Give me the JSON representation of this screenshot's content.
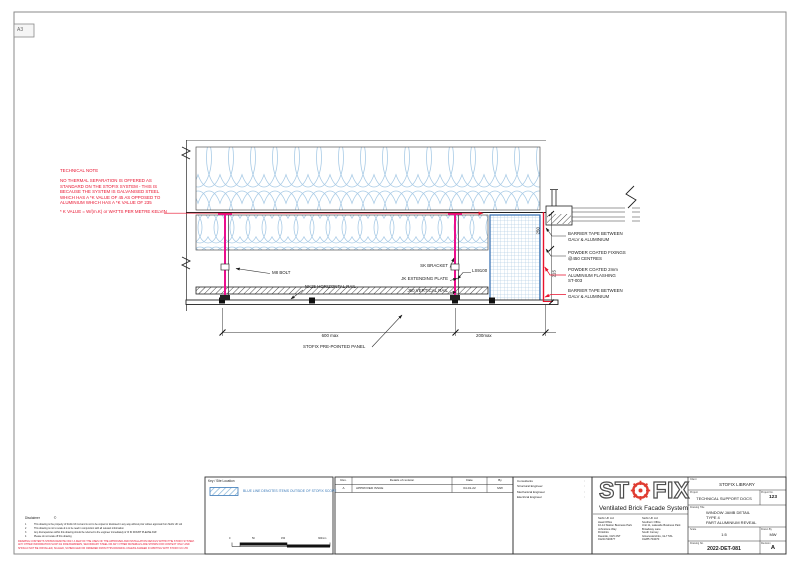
{
  "sheet": {
    "format_label": "A3"
  },
  "technical_note": {
    "title": "TECHNICAL NOTE",
    "lines": [
      "NO THERMAL SEPARATION IS OFFERED AS",
      "STANDARD ON THE STOFIX SYSTEM - THIS IS",
      "BECAUSE THE SYSTEM IS GALVANISED STEEL",
      "WHICH HAS A *K VALUE OF 45 AS OPPOSED TO",
      "ALUMINIUM WHICH HAS A *K VALUE OF 235"
    ],
    "footnote": "* K VALUE = W/(m.K) or WATTS PER METRE KELVIN"
  },
  "callouts": {
    "m8_bolt": "M8 BOLT",
    "nk25_rail": "NK25 HORIZONTAL RAIL",
    "sk_bracket": "SK BRACKET",
    "jk_plate": "JK EXTENDING PLATE",
    "j60_rail": "J60 VERTICAL RAIL",
    "ls9100": "LS9100",
    "barrier_tape_upper": [
      "BARRIER TAPE BETWEEN",
      "GALV & ALUMINIUM"
    ],
    "fixings": [
      "POWDER COATED FIXINGS",
      "@450 CENTRES"
    ],
    "flashing": [
      "POWDER COATED 2mm",
      "ALUMINIUM FLASHING",
      "ST-003"
    ],
    "barrier_tape_lower": [
      "BARRIER TAPE BETWEEN",
      "GALV & ALUMINIUM"
    ],
    "panel": "STOFIX PRE-POINTED PANEL"
  },
  "dimensions": {
    "span_main": "600 max",
    "span_right": "200max",
    "vert_upper": "250",
    "vert_lower": "215"
  },
  "disclaimer": {
    "title": "Disclaimer",
    "copyright": "©",
    "items": [
      {
        "num": "1",
        "text": "This drawing is the property of Stofix UK Ltd and is not to be copied or disclosed in any way without prior written approval from Stofix UK Ltd"
      },
      {
        "num": "2",
        "text": "This drawing is not to scale & is to be read in conjunction with all relevant information"
      },
      {
        "num": "3",
        "text": "Any discrepancies within this drawing should be referred to the engineer immediately & 'IF IN DOUBT PLEASE ASK'"
      },
      {
        "num": "4",
        "text": "Please do not scale off this drawing"
      }
    ],
    "warning": "DRAWING CONTENTS SHOWN DENOTE ONLY A FEW OF THE USES OF THE APPROVED AND INSTALLATION DETAILS WITHIN THE STOFIX SYSTEM. ANY OTHER INFORMATION SUCH AS FIRE BARRIERS, SECONDARY STEEL OR ANY OTHER MATERIALS ARE SHOWN FOR CONTEXT ONLY AND SHOULD NOT BE INSTALLED, SCALED, SCHEDULED OR ORDERED FROM THIS DRAWING UNLESS AGREED IN WRITING WITH STOFIX UK LTD"
  },
  "key_box": {
    "title": "Key / Site Location",
    "legend_text": "BLUE LINE DENOTES ITEMS OUTSIDE OF STOFIX SCOPE",
    "scale_bar_labels": [
      "0",
      "50",
      "150",
      "300mm"
    ]
  },
  "revision_table": {
    "headers": {
      "rev": "Rev.",
      "details": "Details of revision",
      "date": "Date",
      "by": "By"
    },
    "rows": [
      {
        "rev": "A",
        "details": "APPROVED ISSUE",
        "date": "04-01-22",
        "by": "MW"
      }
    ]
  },
  "consultants": {
    "rows": [
      {
        "label": "Consultants",
        "sep": ":"
      },
      {
        "label": "Structural Engineer",
        "sep": ":"
      },
      {
        "label": "Mechanical Engineer",
        "sep": ":"
      },
      {
        "label": "Electrical Engineer",
        "sep": ":"
      }
    ]
  },
  "title_block": {
    "logo": {
      "left": "ST",
      "right": "FIX",
      "tagline": "Ventilated Brick Facade System"
    },
    "address_left": [
      "Stofix UK Ltd",
      "Head Office",
      "10-14 Station Business Park",
      "Johnstone Way",
      "Flintshire",
      "Deeside, CH5 2NT",
      "01244 520677"
    ],
    "address_right": [
      "Stofix UK Ltd",
      "Southern Office",
      "Unit 11, Lakeside Business Park",
      "Broadway Lane",
      "South Cerney",
      "Gloucestershire, GL7 5XL",
      "01285 704070"
    ],
    "fields": {
      "client_label": "Client",
      "client": "STOFIX LIBRARY",
      "project_label": "Project",
      "project": "TECHNICAL SUPPORT DOCS",
      "project_no_label": "Project No.",
      "project_no": "123",
      "drawing_title_label": "Drawing Title",
      "drawing_title_lines": [
        "WINDOW JAMB DETAIL",
        "TYPE 4",
        "PART ALUMINIUM REVEAL"
      ],
      "scale_label": "Scale",
      "scale": "1:5",
      "drawn_by_label": "Drawn By",
      "drawn_by": "MW",
      "drawing_no_label": "Drawing No.",
      "drawing_no": "2022-DET-081",
      "revision_label": "Revision",
      "revision": "A"
    }
  },
  "colors": {
    "note_red": "#e8112d",
    "bracket_magenta": "#ec0f8e",
    "insulation_blue": "#a9cbe6",
    "scope_blue": "#3a79b8",
    "logo_red": "#e03c31"
  }
}
